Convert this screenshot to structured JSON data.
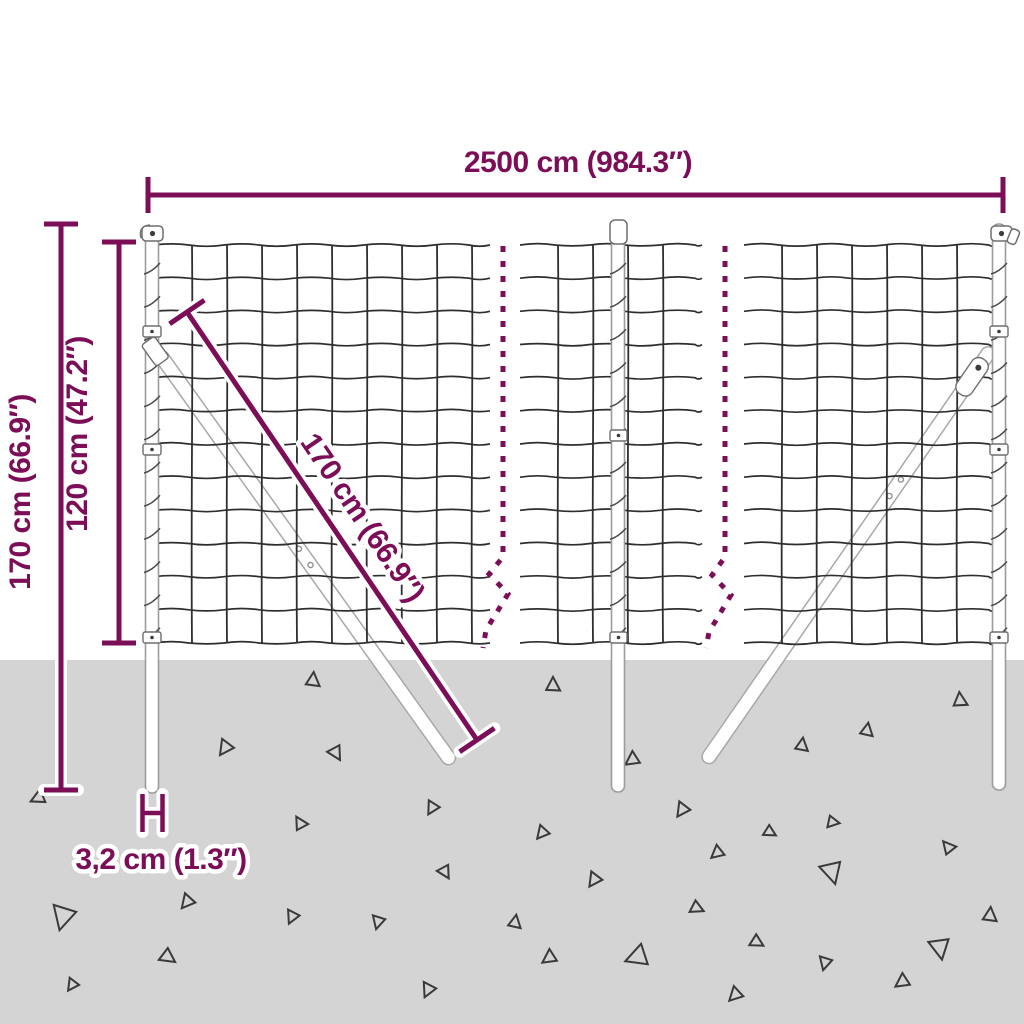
{
  "colors": {
    "dimension": "#7B0E56",
    "ground": "#D4D4D4",
    "wire": "#2E2E2E",
    "spiral": "#4A4A4A",
    "post_fill": "#FFFFFF",
    "post_outline": "#9C9C9C",
    "debris": "#3A3A3A",
    "background": "#FFFFFF"
  },
  "labels": {
    "total_width": "2500 cm (984.3″)",
    "total_height": "170 cm (66.9″)",
    "mesh_height": "120 cm (47.2″)",
    "diagonal_brace": "170 cm (66.9″)",
    "post_thickness": "3,2 cm (1.3″)"
  },
  "ground": {
    "triangles": [
      [
        313,
        680,
        13,
        5
      ],
      [
        553,
        685,
        13,
        0
      ],
      [
        960,
        700,
        13,
        355
      ],
      [
        867,
        730,
        12,
        10
      ],
      [
        802,
        745,
        12,
        8
      ],
      [
        225,
        748,
        14,
        215
      ],
      [
        336,
        753,
        13,
        150
      ],
      [
        632,
        760,
        13,
        235
      ],
      [
        38,
        798,
        13,
        245
      ],
      [
        682,
        810,
        13,
        215
      ],
      [
        432,
        808,
        12,
        210
      ],
      [
        300,
        823,
        12,
        330
      ],
      [
        833,
        822,
        11,
        100
      ],
      [
        542,
        833,
        12,
        220
      ],
      [
        770,
        832,
        11,
        120
      ],
      [
        948,
        847,
        12,
        320
      ],
      [
        717,
        853,
        12,
        230
      ],
      [
        445,
        872,
        12,
        150
      ],
      [
        832,
        872,
        20,
        165
      ],
      [
        594,
        880,
        13,
        215
      ],
      [
        187,
        902,
        13,
        220
      ],
      [
        63,
        917,
        22,
        195
      ],
      [
        292,
        917,
        12,
        205
      ],
      [
        378,
        922,
        12,
        195
      ],
      [
        515,
        922,
        12,
        10
      ],
      [
        697,
        908,
        12,
        115
      ],
      [
        990,
        915,
        13,
        5
      ],
      [
        168,
        957,
        14,
        125
      ],
      [
        549,
        958,
        13,
        235
      ],
      [
        637,
        957,
        20,
        250
      ],
      [
        757,
        942,
        12,
        120
      ],
      [
        825,
        963,
        12,
        195
      ],
      [
        940,
        948,
        19,
        170
      ],
      [
        72,
        985,
        11,
        215
      ],
      [
        428,
        990,
        13,
        205
      ],
      [
        902,
        982,
        13,
        235
      ],
      [
        735,
        995,
        13,
        225
      ]
    ]
  }
}
